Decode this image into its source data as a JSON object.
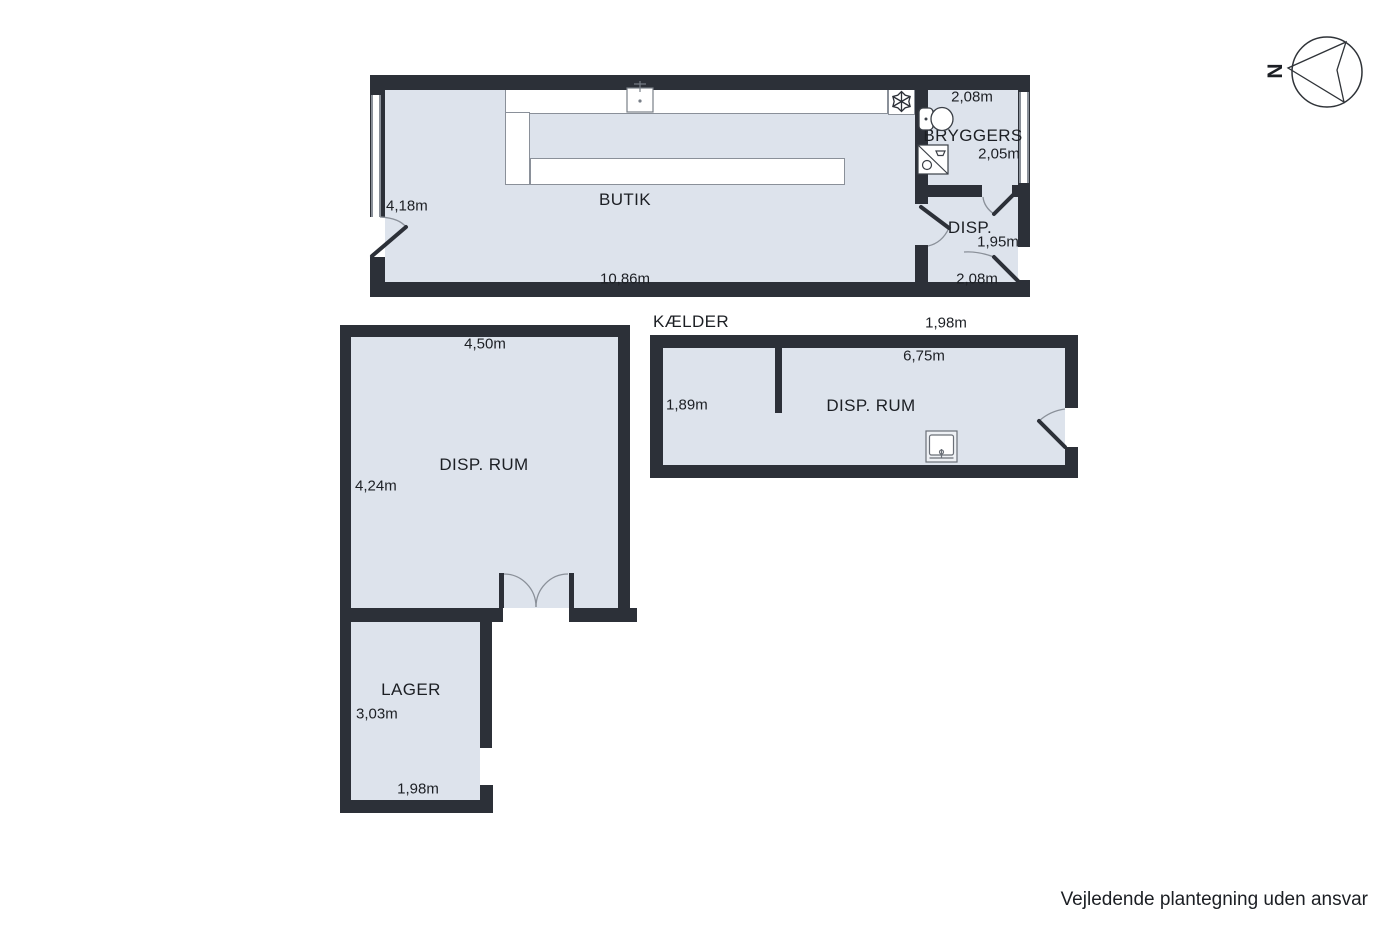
{
  "colors": {
    "floor": "#dde3ec",
    "wall": "#2c3038",
    "line": "#8a9099"
  },
  "ground_floor": {
    "butik": {
      "name": "BUTIK",
      "width": "10,86m",
      "depth": "4,18m"
    },
    "bryggers": {
      "name": "BRYGGERS",
      "width": "2,08m",
      "depth": "2,05m"
    },
    "disp": {
      "name": "DISP.",
      "depth": "1,95m",
      "width": "2,08m"
    }
  },
  "basement": {
    "title": "KÆLDER",
    "dim_top_right": "1,98m",
    "disp_rum": {
      "name": "DISP. RUM",
      "width": "6,75m",
      "depth": "1,89m"
    }
  },
  "annex": {
    "disp_rum": {
      "name": "DISP. RUM",
      "width": "4,50m",
      "depth": "4,24m"
    },
    "lager": {
      "name": "LAGER",
      "depth": "3,03m",
      "width": "1,98m"
    }
  },
  "compass": {
    "north_label": "N"
  },
  "footer": {
    "disclaimer": "Vejledende plantegning uden ansvar"
  },
  "icons": {
    "freezer": "snowflake-icon",
    "counter_sink": "sink-icon",
    "toilet": "toilet-icon",
    "shower": "shower-icon",
    "basement_sink": "basin-icon",
    "compass": "compass-icon"
  }
}
